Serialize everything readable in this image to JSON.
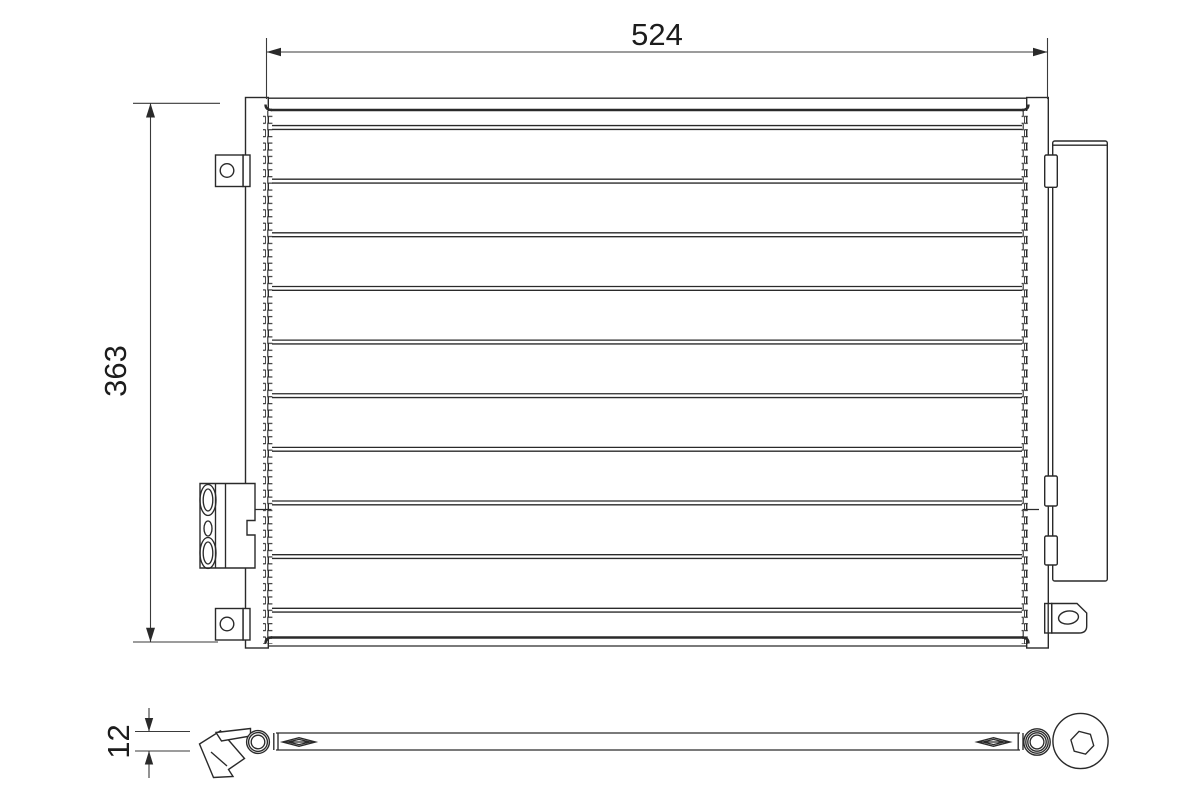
{
  "drawing": {
    "type": "technical-line-drawing",
    "subject": "condenser-front-and-bottom-view",
    "background_color": "#ffffff",
    "line_color": "#2a2a2a",
    "dimensions": {
      "width": "524",
      "height": "363",
      "depth": "12"
    }
  }
}
